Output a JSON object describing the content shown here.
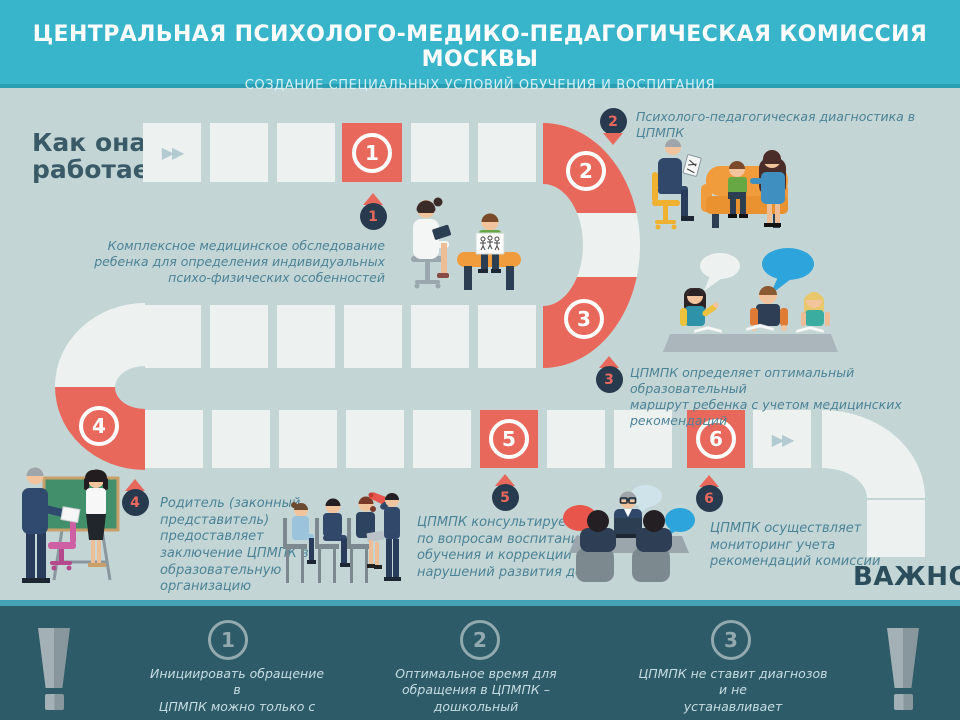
{
  "header": {
    "title": "ЦЕНТРАЛЬНАЯ ПСИХОЛОГО-МЕДИКО-ПЕДАГОГИЧЕСКАЯ КОМИССИЯ МОСКВЫ",
    "subtitle": "СОЗДАНИЕ СПЕЦИАЛЬНЫХ УСЛОВИЙ ОБУЧЕНИЯ И ВОСПИТАНИЯ"
  },
  "intro": {
    "heading": "Как она\nработает?"
  },
  "icons": {
    "fast_forward": "▶▶"
  },
  "board": {
    "steps": [
      {
        "number": "1",
        "label": "Комплексное медицинское обследование\nребенка для определения индивидуальных\nпсихо-физических особенностей"
      },
      {
        "number": "2",
        "label": "Психолого-педагогическая диагностика в ЦПМПК"
      },
      {
        "number": "3",
        "label": "ЦПМПК определяет оптимальный образовательный\nмаршрут ребенка с учетом медицинских рекомендаций"
      },
      {
        "number": "4",
        "label": "Родитель (законный\nпредставитель)\nпредоставляет\nзаключение ЦПМПК в\nобразовательную\nорганизацию"
      },
      {
        "number": "5",
        "label": "ЦПМПК  консультирует\nпо вопросам воспитания,\nобучения и коррекции\nнарушений развития детей"
      },
      {
        "number": "6",
        "label": "ЦПМПК осуществляет\nмониторинг учета\nрекомендаций комиссии"
      }
    ]
  },
  "important": {
    "heading": "ВАЖНО!",
    "items": [
      {
        "number": "1",
        "text": "Инициировать обращение в\nЦПМПК можно только с согласия\nродителя"
      },
      {
        "number": "2",
        "text": "Оптимальное время для\nобращения в ЦПМПК – дошкольный\nвозраст или начальные классы"
      },
      {
        "number": "3",
        "text": "ЦПМПК не ставит диагнозов и не\nустанавливает инвалидность"
      }
    ]
  },
  "colors": {
    "header_cyan": "#39b5cb",
    "background": "#c3d6d5",
    "path_square": "#edf2f1",
    "accent_red": "#e8695c",
    "pin_navy": "#283a4e",
    "label_teal": "#4c8296",
    "footer_dark_teal": "#2e5b68",
    "footer_separator": "#43a3b4",
    "heading_slate": "#3b5a68"
  }
}
